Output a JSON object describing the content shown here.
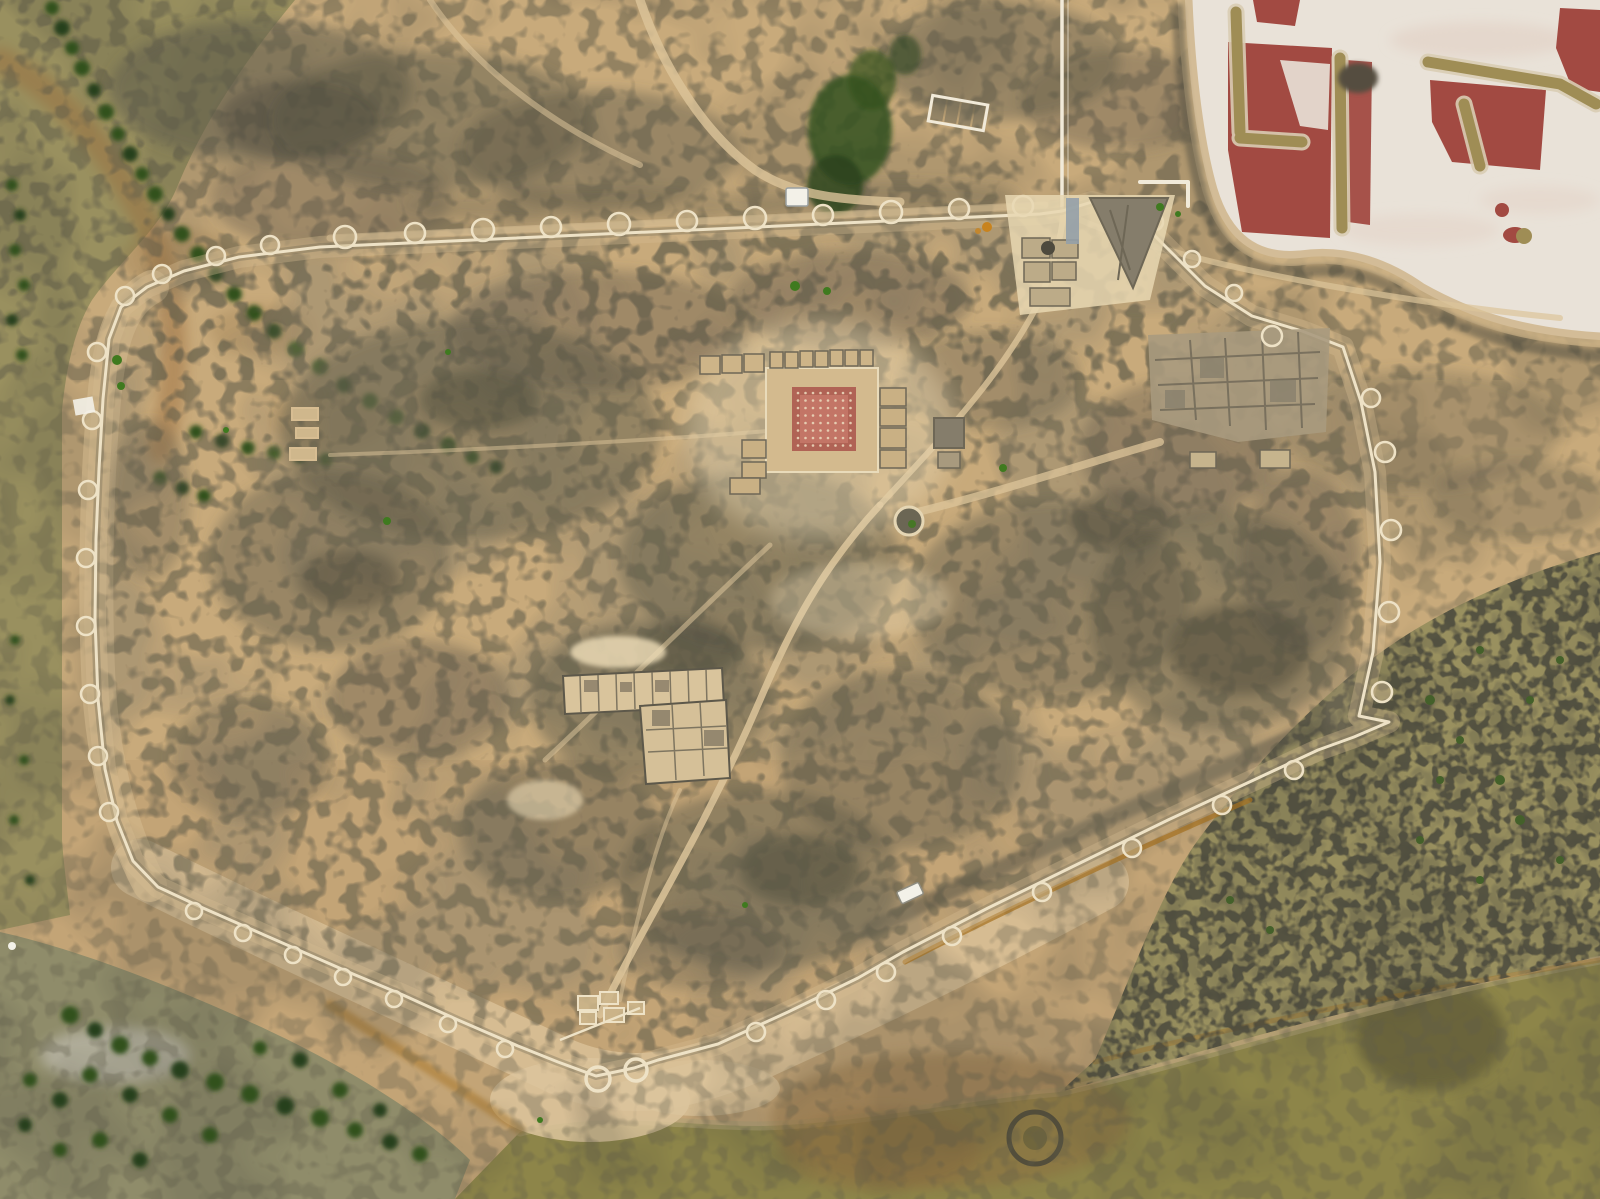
{
  "meta": {
    "description": "Vertical aerial orthophoto of a walled archaeological site on a coastal promontory: polygonal circuit wall with round bastions, excavated central courtyard building with reddish floor, room blocks, salt evaporation ponds with red brine at the top right, olive tidal marsh and water on the left and bottom. No text is visible in the image."
  },
  "colors": {
    "sandBase": "#c8aa7b",
    "sandDeep": "#bb9c6e",
    "sandLight": "#d7bd92",
    "sandPale": "#e8d7b2",
    "beach": "#dcc49c",
    "shoreTan": "#b0a377",
    "bermTan": "#cdb387",
    "scrubDark": "#5f5b4a",
    "scrubDeep": "#45443a",
    "marshOlive": "#99905f",
    "marshGray": "#8f8c6a",
    "waterOlive": "#8d8549",
    "waterDark": "#5f5a38",
    "treeGreen": "#33511e",
    "treeDeep": "#28411a",
    "bushGreen": "#3f7a1f",
    "tuftGreen": "#44602a",
    "wallPale": "#eee2c6",
    "wallShadow": "#6f6753",
    "pathSand": "#dcc49a",
    "roadPale": "#f1ead9",
    "plazaRed": "#b06355",
    "plazaPink": "#c8796a",
    "plazaDot": "#e7d0b5",
    "ruinGray": "#a89a7e",
    "ruinDark": "#857d6b",
    "ruinLine": "#6e6756",
    "saltWhite": "#e9e2d8",
    "saltPink": "#e0ccc0",
    "pondRed": "#a24a42",
    "leveeOlive": "#9f8d55",
    "leveeEdge": "#d9cdb4",
    "rustOrange": "#a5701f",
    "channelBrown": "#9a6b3a",
    "mudBrown": "#8a6c40",
    "grayPatch": "#b7b4a4",
    "white": "#f3f1e8",
    "blueGray": "#93a0a8",
    "darkBlob": "#554e40",
    "orangeDot": "#c8831e"
  },
  "regions": [
    "salt-evaporation-ponds",
    "red-brine-ponds",
    "salina-levees",
    "city-wall-circuit",
    "wall-bastions",
    "south-gate-horseshoe-towers",
    "central-courtyard-building",
    "red-courtyard-floor",
    "round-structure",
    "northeast-bastion-complex",
    "northeast-room-block",
    "l-shaped-excavation",
    "south-gate-rooms",
    "interior-scrub-patches",
    "interior-paths",
    "left-marsh",
    "tree-lines",
    "bottom-water",
    "right-marsh-slope",
    "beach-strip",
    "mud-stain",
    "white-hut",
    "white-vehicle",
    "survey-enclosure"
  ]
}
